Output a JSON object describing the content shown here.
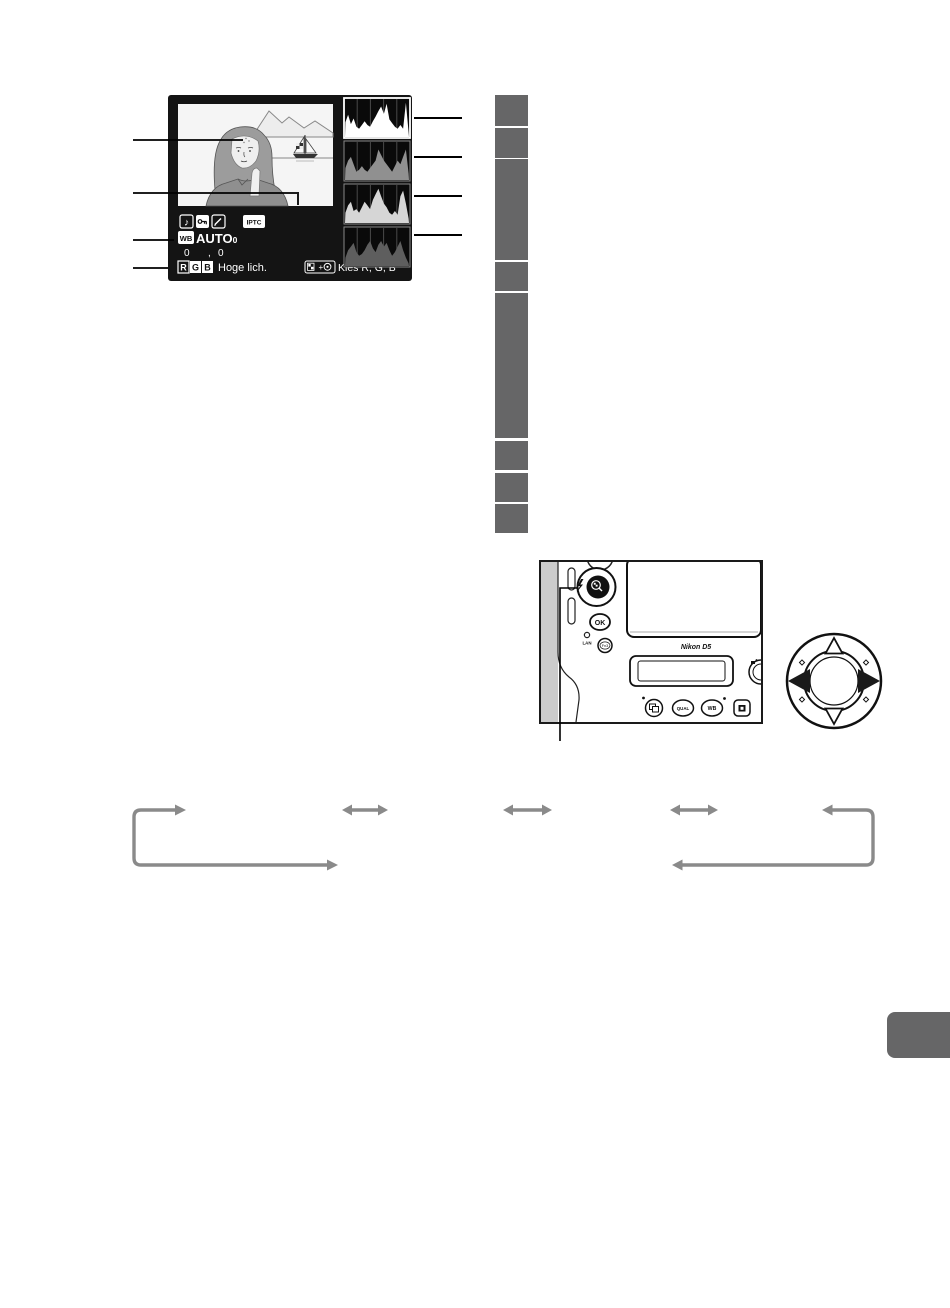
{
  "display": {
    "iptc_badge": "IPTC",
    "wb_badge": "WB",
    "wb_value": "AUTO",
    "wb_value_sub": "0",
    "finetune_a": "0",
    "finetune_comma": ",",
    "finetune_b": "0",
    "rgb_chips": [
      "R",
      "G",
      "B"
    ],
    "mode_label": "Hoge lich.",
    "hint_label": "Kies R, G, B"
  },
  "histograms": {
    "channels": [
      {
        "name": "rgb-luminance",
        "color": "#ffffff",
        "bins": [
          16,
          24,
          14,
          20,
          11,
          9,
          13,
          17,
          13,
          11,
          17,
          22,
          28,
          33,
          25,
          36,
          19,
          15,
          11,
          9,
          13,
          9,
          37,
          5
        ]
      },
      {
        "name": "red-channel",
        "color": "#909090",
        "bins": [
          13,
          21,
          25,
          17,
          9,
          11,
          15,
          11,
          9,
          13,
          17,
          21,
          33,
          27,
          21,
          17,
          13,
          9,
          15,
          21,
          17,
          25,
          33,
          7
        ]
      },
      {
        "name": "green-channel",
        "color": "#d6d6d6",
        "bins": [
          11,
          19,
          23,
          13,
          15,
          11,
          17,
          23,
          19,
          15,
          25,
          31,
          37,
          29,
          21,
          17,
          11,
          9,
          13,
          9,
          29,
          35,
          21,
          5
        ]
      },
      {
        "name": "blue-channel",
        "color": "#5e5e5e",
        "bins": [
          9,
          17,
          21,
          25,
          15,
          11,
          13,
          17,
          23,
          27,
          19,
          15,
          23,
          27,
          21,
          25,
          17,
          11,
          15,
          21,
          27,
          17,
          9,
          3
        ]
      }
    ]
  },
  "camera": {
    "logo": "Nikon D5",
    "ok": "OK",
    "lan": "LAN",
    "fn3": "Fn3",
    "qual": "QUAL",
    "wb": "WB"
  },
  "colors": {
    "redaction": "#666667",
    "arrow": "#8a8a8a",
    "tab": "#666667",
    "display_bg": "#141414"
  }
}
